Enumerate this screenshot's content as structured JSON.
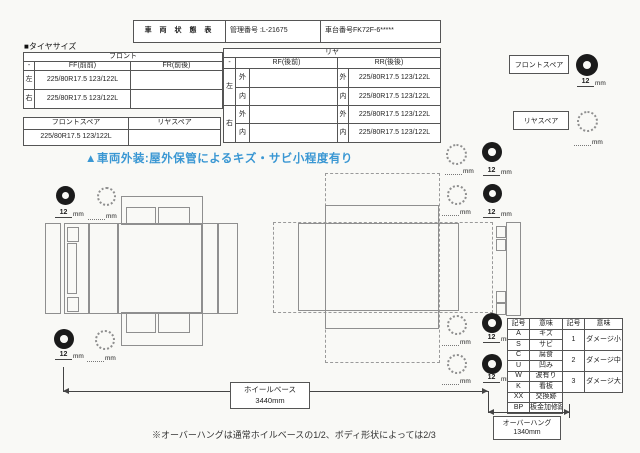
{
  "colors": {
    "accent_blue": "#3a97d3",
    "diagram_gray": "#8f8f8f",
    "border_gray": "#555555",
    "tire_black": "#1b1b1b"
  },
  "header": {
    "title": "車 両 状 態 表",
    "mgmt_label": "管理番号",
    "mgmt_value": ":L-21675",
    "chassis_label": "車台番号",
    "chassis_value": "FK72F-6*****"
  },
  "tire": {
    "section_label": "■タイヤサイズ",
    "front": {
      "title": "フロント",
      "corner": "-",
      "col1": "FF(前前)",
      "col2": "FR(前後)",
      "rows": [
        {
          "side": "左",
          "ff": "225/80R17.5 123/122L",
          "fr": ""
        },
        {
          "side": "右",
          "ff": "225/80R17.5 123/122L",
          "fr": ""
        }
      ]
    },
    "rear": {
      "title": "リヤ",
      "corner": "-",
      "col1": "RF(後前)",
      "col2": "RR(後後)",
      "sides": [
        "左",
        "右"
      ],
      "rows": [
        {
          "io": "外",
          "rf": "",
          "rr": "225/80R17.5 123/122L"
        },
        {
          "io": "内",
          "rf": "",
          "rr": "225/80R17.5 123/122L"
        },
        {
          "io": "外",
          "rf": "",
          "rr": "225/80R17.5 123/122L"
        },
        {
          "io": "内",
          "rf": "",
          "rr": "225/80R17.5 123/122L"
        }
      ]
    },
    "spare": {
      "col1": "フロントスペア",
      "col2": "リヤスペア",
      "front_value": "225/80R17.5 123/122L",
      "rear_value": ""
    }
  },
  "spare_panel": {
    "front_label": "フロントスペア",
    "rear_label": "リヤスペア"
  },
  "tread": {
    "value": "12",
    "unit": "mm"
  },
  "warning": "▲車両外装:屋外保管によるキズ・サビ小程度有り",
  "legend": {
    "h1": "記号",
    "h2": "意味",
    "h3": "記号",
    "h4": "意味",
    "symbols": [
      {
        "code": "A",
        "meaning": "キズ"
      },
      {
        "code": "S",
        "meaning": "サビ"
      },
      {
        "code": "C",
        "meaning": "腐食"
      },
      {
        "code": "U",
        "meaning": "凹み"
      },
      {
        "code": "W",
        "meaning": "波有り"
      },
      {
        "code": "K",
        "meaning": "看板"
      },
      {
        "code": "XX",
        "meaning": "交換跡"
      },
      {
        "code": "BP",
        "meaning": "板金加修跡"
      }
    ],
    "levels": [
      {
        "code": "1",
        "meaning": "ダメージ小"
      },
      {
        "code": "2",
        "meaning": "ダメージ中"
      },
      {
        "code": "3",
        "meaning": "ダメージ大"
      }
    ]
  },
  "dimensions": {
    "wheelbase_label": "ホイールベース",
    "wheelbase_value": "3440mm",
    "overhang_label": "オーバーハング",
    "overhang_value": "1340mm"
  },
  "note": "※オーバーハングは通常ホイルベースの1/2、ボディ形状によっては2/3"
}
